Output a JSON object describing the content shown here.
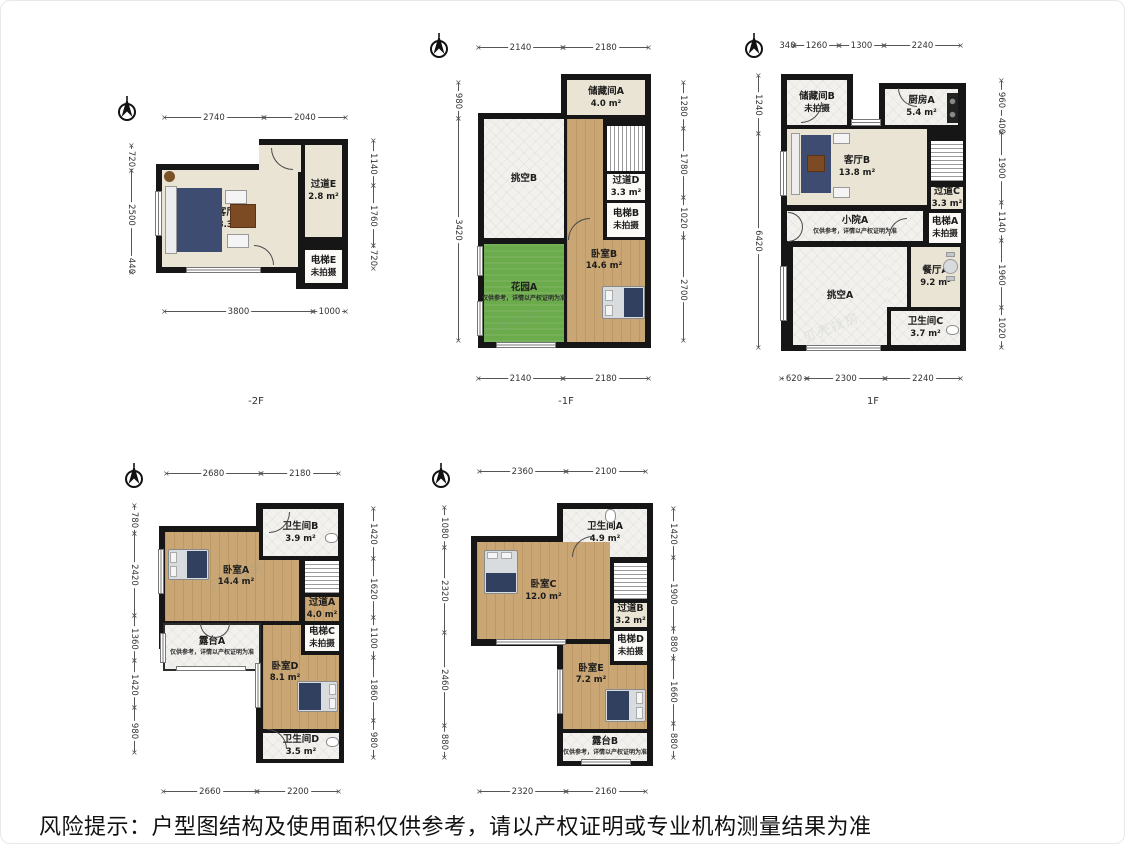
{
  "footer": "风险提示：户型图结构及使用面积仅供参考，请以产权证明或专业机构测量结果为准",
  "watermark": "贝壳找房",
  "plans": [
    {
      "floor": "-2F",
      "rooms": {
        "living": {
          "name": "客厅A",
          "area": "18.3 m²"
        },
        "hall": {
          "name": "过道E",
          "area": "2.8 m²"
        },
        "lift": {
          "name": "电梯E",
          "note": "未拍摄"
        }
      },
      "dims": {
        "top": [
          "2740",
          "2040"
        ],
        "left": [
          "720",
          "2500",
          "440"
        ],
        "right": [
          "1140",
          "1760",
          "720"
        ],
        "bottom": [
          "3800",
          "1000"
        ]
      }
    },
    {
      "floor": "-1F",
      "rooms": {
        "storage": {
          "name": "储藏间A",
          "area": "4.0 m²"
        },
        "void": {
          "name": "挑空B"
        },
        "hall": {
          "name": "过道D",
          "area": "3.3 m²"
        },
        "lift": {
          "name": "电梯B",
          "note": "未拍摄"
        },
        "bedroom": {
          "name": "卧室B",
          "area": "14.6 m²"
        },
        "garden": {
          "name": "花园A",
          "note": "仅供参考，详情以产权证明为准"
        }
      },
      "dims": {
        "top": [
          "2140",
          "2180"
        ],
        "left": [
          "980",
          "3420"
        ],
        "right": [
          "1280",
          "1780",
          "1020",
          "2700"
        ],
        "bottom": [
          "2140",
          "2180"
        ]
      }
    },
    {
      "floor": "1F",
      "rooms": {
        "storage": {
          "name": "储藏间B",
          "note": "未拍摄"
        },
        "kitchen": {
          "name": "厨房A",
          "area": "5.4 m²"
        },
        "living": {
          "name": "客厅B",
          "area": "13.8 m²"
        },
        "hall": {
          "name": "过道C",
          "area": "3.3 m²"
        },
        "lift": {
          "name": "电梯A",
          "note": "未拍摄"
        },
        "yard": {
          "name": "小院A",
          "note": "仅供参考，详情以产权证明为准"
        },
        "dining": {
          "name": "餐厅A",
          "area": "9.2 m²"
        },
        "void": {
          "name": "挑空A"
        },
        "bath": {
          "name": "卫生间C",
          "area": "3.7 m²"
        }
      },
      "dims": {
        "top": [
          "340",
          "1260",
          "1300",
          "2240"
        ],
        "left": [
          "1240",
          "6420"
        ],
        "right": [
          "960",
          "400",
          "1900",
          "1140",
          "1960",
          "1020"
        ],
        "bottom": [
          "620",
          "2300",
          "2240"
        ]
      }
    },
    {
      "floor": "",
      "rooms": {
        "bath_b": {
          "name": "卫生间B",
          "area": "3.9 m²"
        },
        "bedroom_a": {
          "name": "卧室A",
          "area": "14.4 m²"
        },
        "hall": {
          "name": "过道A",
          "area": "4.0 m²"
        },
        "lift": {
          "name": "电梯C",
          "note": "未拍摄"
        },
        "terrace": {
          "name": "露台A",
          "note": "仅供参考，详情以产权证明为准"
        },
        "bedroom_d": {
          "name": "卧室D",
          "area": "8.1 m²"
        },
        "bath_d": {
          "name": "卫生间D",
          "area": "3.5 m²"
        }
      },
      "dims": {
        "top": [
          "2680",
          "2180"
        ],
        "left": [
          "780",
          "2420",
          "1360",
          "1420",
          "980"
        ],
        "right": [
          "1420",
          "1620",
          "1100",
          "1860",
          "980"
        ],
        "bottom": [
          "2660",
          "2200"
        ]
      }
    },
    {
      "floor": "",
      "rooms": {
        "bath_a": {
          "name": "卫生间A",
          "area": "4.9 m²"
        },
        "bedroom_c": {
          "name": "卧室C",
          "area": "12.0 m²"
        },
        "hall": {
          "name": "过道B",
          "area": "3.2 m²"
        },
        "lift": {
          "name": "电梯D",
          "note": "未拍摄"
        },
        "bedroom_e": {
          "name": "卧室E",
          "area": "7.2 m²"
        },
        "terrace": {
          "name": "露台B",
          "note": "仅供参考，详情以产权证明为准"
        }
      },
      "dims": {
        "top": [
          "2360",
          "2100"
        ],
        "left": [
          "1080",
          "2320",
          "2460",
          "880"
        ],
        "right": [
          "1420",
          "1900",
          "880",
          "1660",
          "880"
        ],
        "bottom": [
          "2320",
          "2160"
        ]
      }
    }
  ]
}
